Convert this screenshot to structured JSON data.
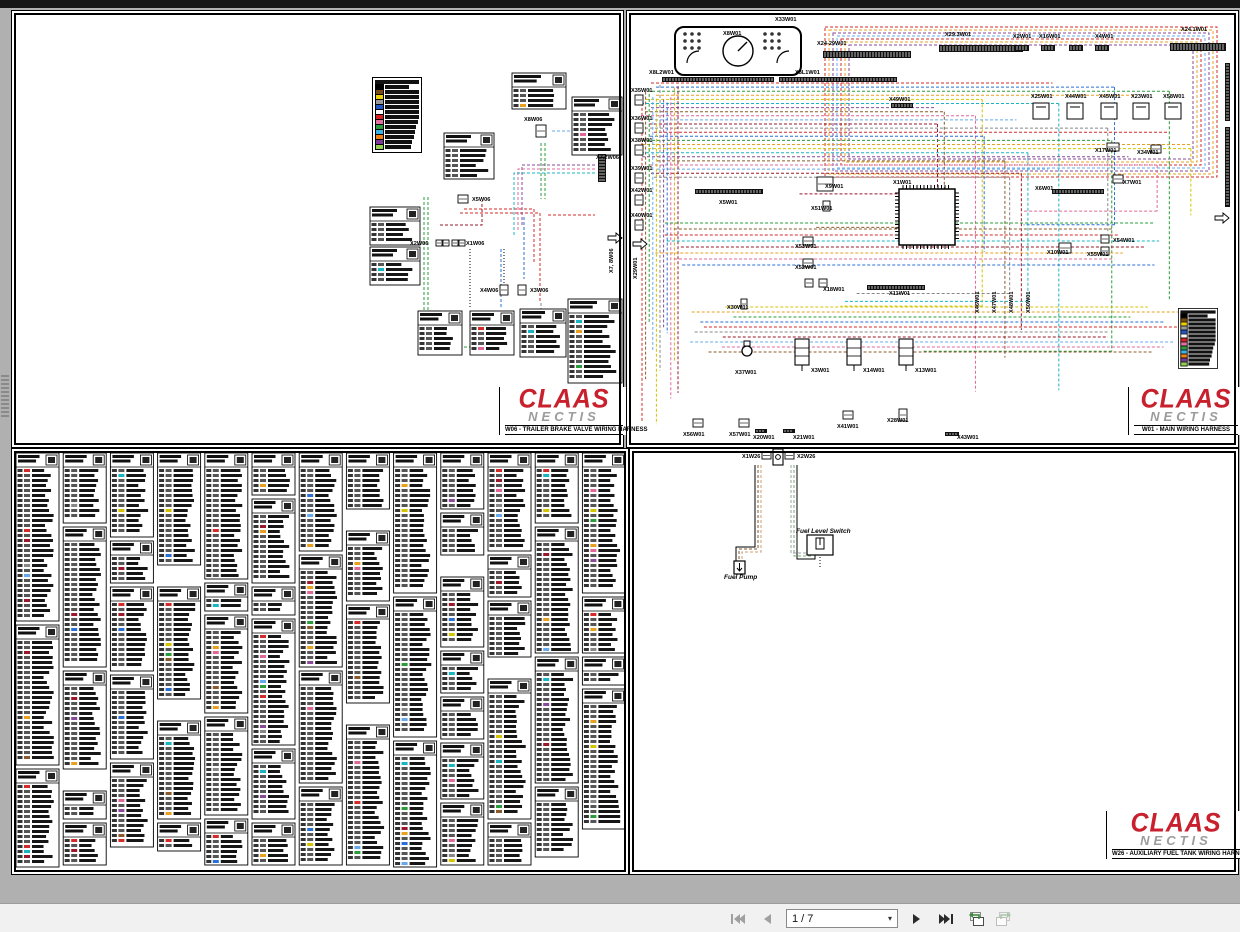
{
  "brand": {
    "name": "CLAAS",
    "sub": "NECTIS",
    "color": "#c8202c"
  },
  "toolbar": {
    "page_display": "1 / 7",
    "buttons": [
      {
        "name": "first-page",
        "enabled": false
      },
      {
        "name": "previous-page",
        "enabled": false
      },
      {
        "name": "page-select",
        "enabled": true
      },
      {
        "name": "next-page",
        "enabled": true
      },
      {
        "name": "last-page",
        "enabled": true
      },
      {
        "name": "previous-view",
        "enabled": true
      },
      {
        "name": "next-view",
        "enabled": false
      }
    ]
  },
  "legend": {
    "colors": [
      "#000000",
      "#7b4a12",
      "#f0d000",
      "#999999",
      "#1e56c8",
      "#ffffff",
      "#d42222",
      "#e470a0",
      "#2a9d3a",
      "#3ab4e8",
      "#f08010",
      "#7a3a9a",
      "#8fd14f"
    ]
  },
  "pages": {
    "w06": {
      "title": "W06 - TRAILER BRAKE VALVE WIRING HARNESS",
      "connectors": [
        {
          "label": "X8W06",
          "x": 512,
          "y": 110
        },
        {
          "label": "X7.2W06",
          "x": 584,
          "y": 148
        },
        {
          "label": "X5W06",
          "x": 460,
          "y": 190
        },
        {
          "label": "X2W06",
          "x": 398,
          "y": 234
        },
        {
          "label": "X1W06",
          "x": 454,
          "y": 234
        },
        {
          "label": "X4W06",
          "x": 468,
          "y": 281
        },
        {
          "label": "X3W06",
          "x": 518,
          "y": 281
        },
        {
          "label": "X7, 8W06",
          "x": 601,
          "y": 262,
          "rot": -90
        }
      ]
    },
    "w01": {
      "title": "W01 - MAIN WIRING HARNESS",
      "connectors": [
        {
          "label": "X33W01",
          "x": 148,
          "y": 10
        },
        {
          "label": "X8W01",
          "x": 96,
          "y": 24
        },
        {
          "label": "X24-29W01",
          "x": 190,
          "y": 34
        },
        {
          "label": "X29.3W01",
          "x": 318,
          "y": 25
        },
        {
          "label": "X2W01",
          "x": 386,
          "y": 27
        },
        {
          "label": "X16W01",
          "x": 412,
          "y": 27
        },
        {
          "label": "X4W01",
          "x": 468,
          "y": 27
        },
        {
          "label": "X24.1W01",
          "x": 554,
          "y": 20
        },
        {
          "label": "X8L2W01",
          "x": 22,
          "y": 63
        },
        {
          "label": "X8L1W01",
          "x": 168,
          "y": 63
        },
        {
          "label": "X49W01",
          "x": 262,
          "y": 90
        },
        {
          "label": "X25W01",
          "x": 404,
          "y": 87
        },
        {
          "label": "X44W01",
          "x": 438,
          "y": 87
        },
        {
          "label": "X45W01",
          "x": 472,
          "y": 87
        },
        {
          "label": "X23W01",
          "x": 504,
          "y": 87
        },
        {
          "label": "X58W01",
          "x": 536,
          "y": 87
        },
        {
          "label": "X35W01",
          "x": 4,
          "y": 81
        },
        {
          "label": "X36W01",
          "x": 4,
          "y": 109
        },
        {
          "label": "X38W01",
          "x": 4,
          "y": 131
        },
        {
          "label": "X39W01",
          "x": 4,
          "y": 159
        },
        {
          "label": "X42W01",
          "x": 4,
          "y": 181
        },
        {
          "label": "X40W01",
          "x": 4,
          "y": 206
        },
        {
          "label": "X29W01",
          "x": 10,
          "y": 268,
          "rot": -90
        },
        {
          "label": "X17W01",
          "x": 468,
          "y": 141
        },
        {
          "label": "X34W01",
          "x": 510,
          "y": 143
        },
        {
          "label": "X7W01",
          "x": 496,
          "y": 173
        },
        {
          "label": "X6W01",
          "x": 408,
          "y": 179
        },
        {
          "label": "X5W01",
          "x": 92,
          "y": 193
        },
        {
          "label": "X9W01",
          "x": 198,
          "y": 177
        },
        {
          "label": "X51W01",
          "x": 184,
          "y": 199
        },
        {
          "label": "X53W01",
          "x": 168,
          "y": 237
        },
        {
          "label": "X52W01",
          "x": 168,
          "y": 258
        },
        {
          "label": "X18W01",
          "x": 196,
          "y": 280
        },
        {
          "label": "X11W01",
          "x": 262,
          "y": 284
        },
        {
          "label": "X1W01",
          "x": 266,
          "y": 173
        },
        {
          "label": "X10W01",
          "x": 420,
          "y": 243
        },
        {
          "label": "X54W01",
          "x": 486,
          "y": 231
        },
        {
          "label": "X55W01",
          "x": 460,
          "y": 245
        },
        {
          "label": "X46W01",
          "x": 352,
          "y": 302,
          "rot": -90
        },
        {
          "label": "X47W01",
          "x": 369,
          "y": 302,
          "rot": -90
        },
        {
          "label": "X48W01",
          "x": 386,
          "y": 302,
          "rot": -90
        },
        {
          "label": "X50W01",
          "x": 403,
          "y": 302,
          "rot": -90
        },
        {
          "label": "X30W01",
          "x": 100,
          "y": 298
        },
        {
          "label": "X37W01",
          "x": 108,
          "y": 363
        },
        {
          "label": "X3W01",
          "x": 184,
          "y": 361
        },
        {
          "label": "X14W01",
          "x": 236,
          "y": 361
        },
        {
          "label": "X13W01",
          "x": 288,
          "y": 361
        },
        {
          "label": "X56W01",
          "x": 56,
          "y": 425
        },
        {
          "label": "X57W01",
          "x": 102,
          "y": 425
        },
        {
          "label": "X20W01",
          "x": 126,
          "y": 428
        },
        {
          "label": "X21W01",
          "x": 166,
          "y": 428
        },
        {
          "label": "X41W01",
          "x": 210,
          "y": 417
        },
        {
          "label": "X28W01",
          "x": 260,
          "y": 411
        },
        {
          "label": "X43W01",
          "x": 330,
          "y": 428
        }
      ]
    },
    "w26": {
      "title": "W26 - AUXILIARY FUEL TANK WIRING HARNESS",
      "connectors": [
        {
          "label": "X1W26",
          "x": 112,
          "y": 9
        },
        {
          "label": "X2W26",
          "x": 167,
          "y": 9
        }
      ],
      "devices": [
        {
          "label": "Fuel Pump",
          "x": 94,
          "y": 130
        },
        {
          "label": "Fuel Level Switch",
          "x": 166,
          "y": 84
        }
      ]
    }
  }
}
